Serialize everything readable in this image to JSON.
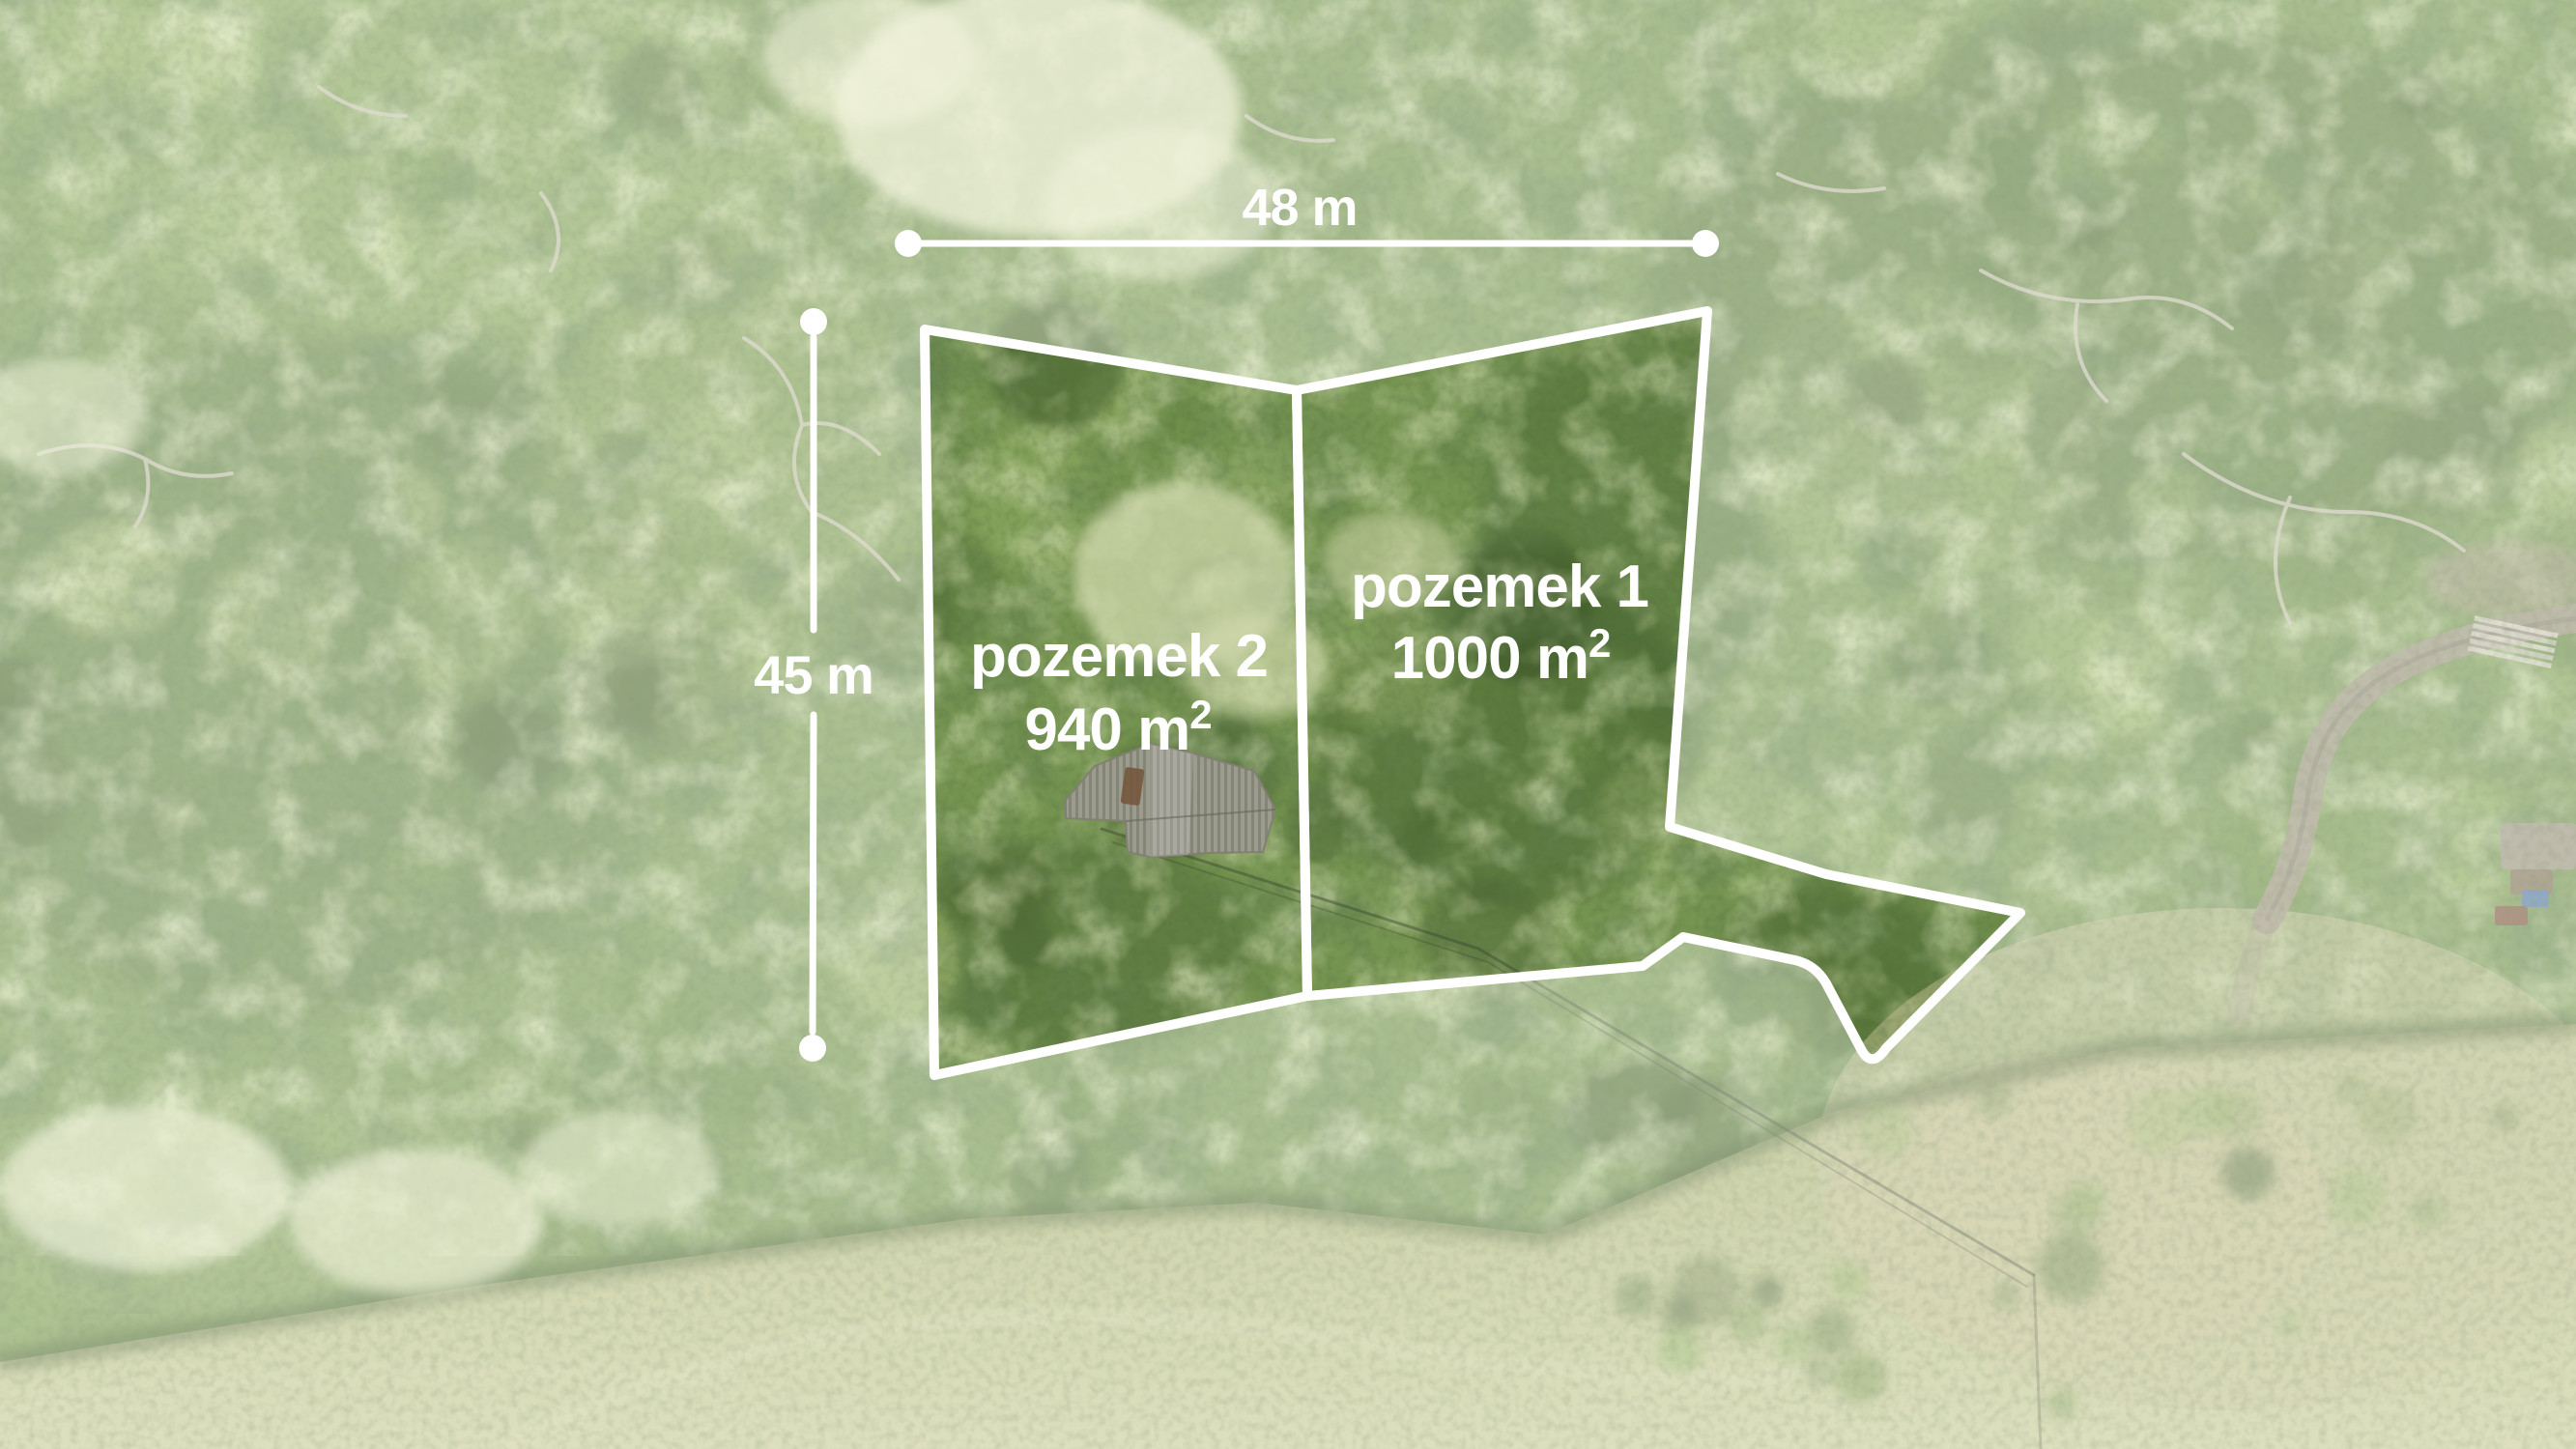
{
  "plots": [
    {
      "id": "plot-1",
      "name": "pozemek 1",
      "area_label": "1000 m²",
      "area_main": "1000 m",
      "area_sup": "2"
    },
    {
      "id": "plot-2",
      "name": "pozemek 2",
      "area_label": "940 m²",
      "area_main": "940 m",
      "area_sup": "2"
    }
  ],
  "dimensions": {
    "width_label": "48 m",
    "height_label": "45 m"
  },
  "palette": {
    "annotation_white": "#ffffff",
    "forest_base": "#7f9e58",
    "forest_dark": "#3f5c2c",
    "forest_mid": "#5e7a42",
    "forest_light": "#9cb86e",
    "bloom_cream": "#ecefcc",
    "field_light": "#ccd09e",
    "field_dark": "#b7bf85",
    "road_tan": "#a29a85",
    "roof_gray": "#a7a49a",
    "roof_rust": "#7d5b41",
    "tarp_blue": "#5a7fae",
    "wire_dark": "#3f4636",
    "canopy_shades": [
      "#46602f",
      "#5d7c3c",
      "#74954a",
      "#8fb05f",
      "#a9c475",
      "#c6d98f",
      "#3a5227",
      "#688745"
    ]
  }
}
